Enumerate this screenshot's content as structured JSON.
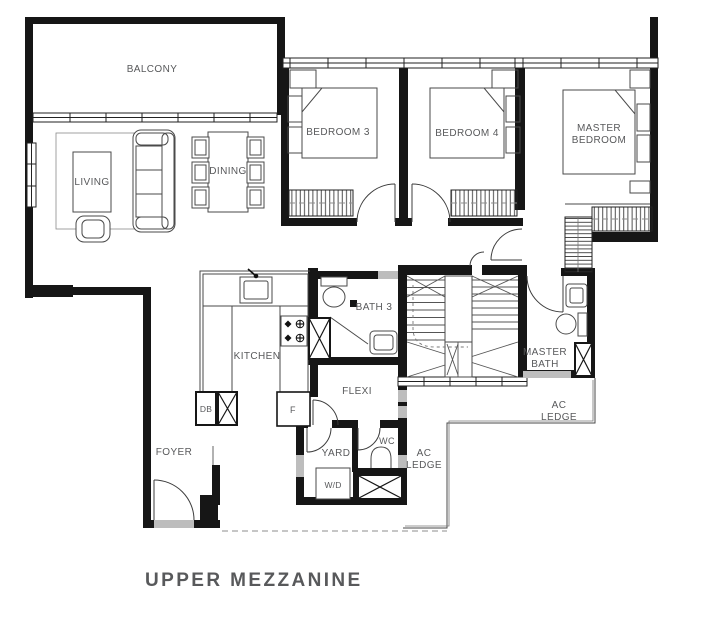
{
  "title": "UPPER MEZZANINE",
  "rooms": {
    "balcony": "BALCONY",
    "living": "LIVING",
    "dining": "DINING",
    "bedroom3": "BEDROOM 3",
    "bedroom4": "BEDROOM 4",
    "master_bedroom": {
      "line1": "MASTER",
      "line2": "BEDROOM"
    },
    "kitchen": "KITCHEN",
    "bath3": "BATH 3",
    "flexi": "FLEXI",
    "master_bath": {
      "line1": "MASTER",
      "line2": "BATH"
    },
    "ac_ledge": {
      "line1": "AC",
      "line2": "LEDGE"
    },
    "foyer": "FOYER",
    "yard": "YARD",
    "wc": "WC"
  },
  "fixtures": {
    "washer_dryer": "W/D",
    "distribution_board": "DB",
    "fridge": "F"
  },
  "colors": {
    "wall": "#161616",
    "label": "#58595b",
    "line": "#4a4a4a"
  }
}
